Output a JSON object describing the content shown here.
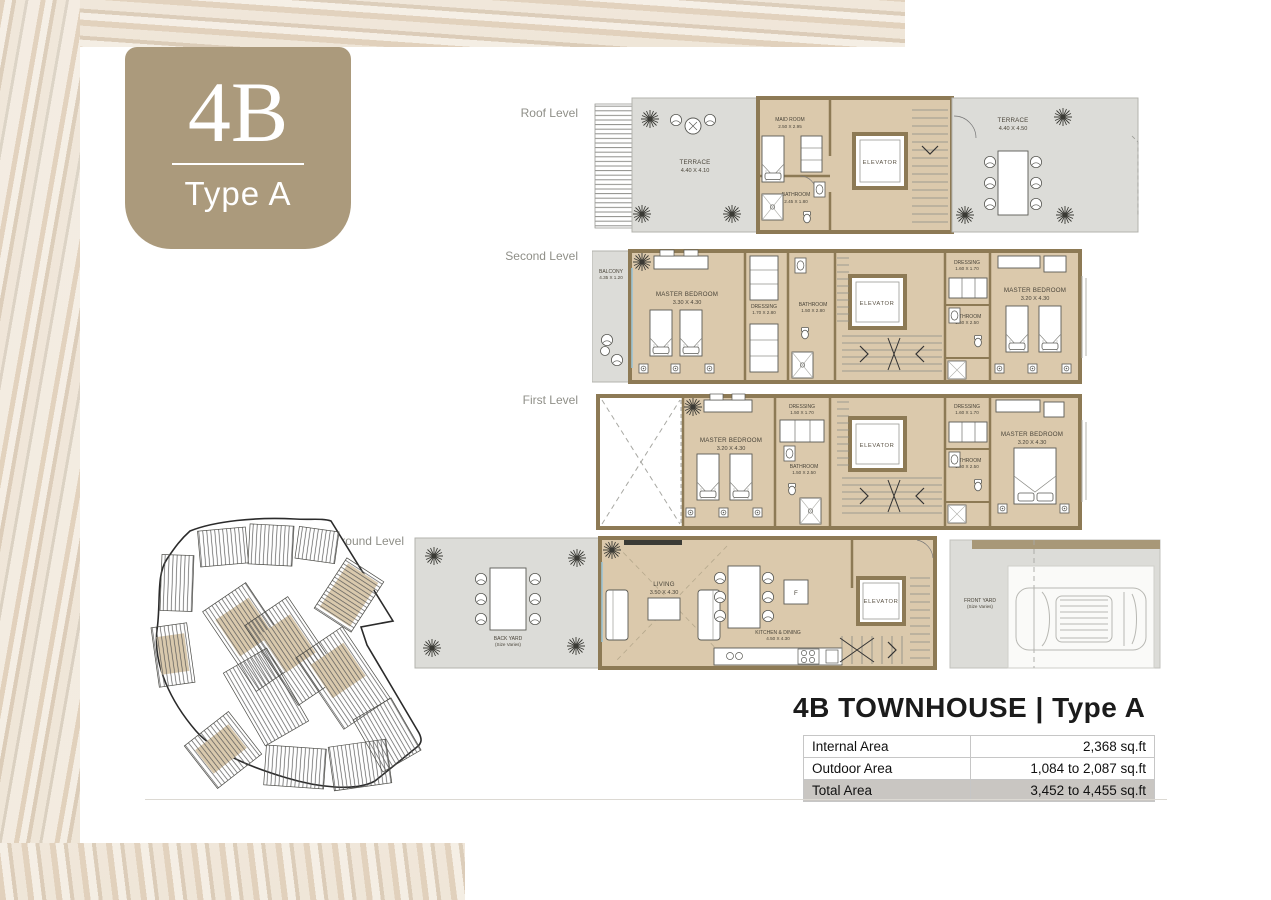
{
  "badge": {
    "code": "4B",
    "type": "Type A"
  },
  "title": "4B TOWNHOUSE | Type A",
  "area_table": {
    "rows": [
      {
        "label": "Internal Area",
        "value": "2,368 sq.ft"
      },
      {
        "label": "Outdoor Area",
        "value": "1,084 to 2,087 sq.ft"
      },
      {
        "label": "Total Area",
        "value": "3,452 to 4,455 sq.ft"
      }
    ]
  },
  "levels": [
    {
      "label": "Roof Level",
      "rooms": [
        {
          "name": "TERRACE",
          "dims": "4.40 X 4.10"
        },
        {
          "name": "MAID ROOM",
          "dims": "2.50 X 2.95"
        },
        {
          "name": "BATHROOM",
          "dims": "2.45 X 1.80"
        },
        {
          "name": "ELEVATOR",
          "dims": ""
        },
        {
          "name": "TERRACE",
          "dims": "4.40 X 4.50"
        }
      ]
    },
    {
      "label": "Second Level",
      "rooms": [
        {
          "name": "BALCONY",
          "dims": "4.35 X 1.20"
        },
        {
          "name": "MASTER BEDROOM",
          "dims": "3.30 X 4.30"
        },
        {
          "name": "DRESSING",
          "dims": "1.70 X 2.80"
        },
        {
          "name": "BATHROOM",
          "dims": "1.50 X 2.80"
        },
        {
          "name": "ELEVATOR",
          "dims": ""
        },
        {
          "name": "DRESSING",
          "dims": "1.60 X 1.70"
        },
        {
          "name": "BATHROOM",
          "dims": "1.60 X 2.50"
        },
        {
          "name": "MASTER BEDROOM",
          "dims": "3.20 X 4.30"
        }
      ]
    },
    {
      "label": "First Level",
      "rooms": [
        {
          "name": "MASTER BEDROOM",
          "dims": "3.20 X 4.30"
        },
        {
          "name": "DRESSING",
          "dims": "1.50 X 1.70"
        },
        {
          "name": "BATHROOM",
          "dims": "1.50 X 2.50"
        },
        {
          "name": "ELEVATOR",
          "dims": ""
        },
        {
          "name": "DRESSING",
          "dims": "1.60 X 1.70"
        },
        {
          "name": "BATHROOM",
          "dims": "1.60 X 2.50"
        },
        {
          "name": "MASTER BEDROOM",
          "dims": "3.20 X 4.30"
        }
      ]
    },
    {
      "label": "Ground Level",
      "rooms": [
        {
          "name": "BACK YARD",
          "dims": "(Size Varies)"
        },
        {
          "name": "LIVING",
          "dims": "3.50 X 4.30"
        },
        {
          "name": "KITCHEN & DINING",
          "dims": "4.50 X 4.30"
        },
        {
          "name": "ELEVATOR",
          "dims": ""
        },
        {
          "name": "FRONT YARD",
          "dims": "(Size Varies)"
        }
      ],
      "fridge_label": "F"
    }
  ],
  "colors": {
    "badge_bg": "#ab9a7c",
    "plan_interior": "#dbc9ac",
    "plan_outdoor": "#dcdcd8",
    "plan_wall": "#8d7a55",
    "total_row_bg": "#c9c6c2"
  }
}
